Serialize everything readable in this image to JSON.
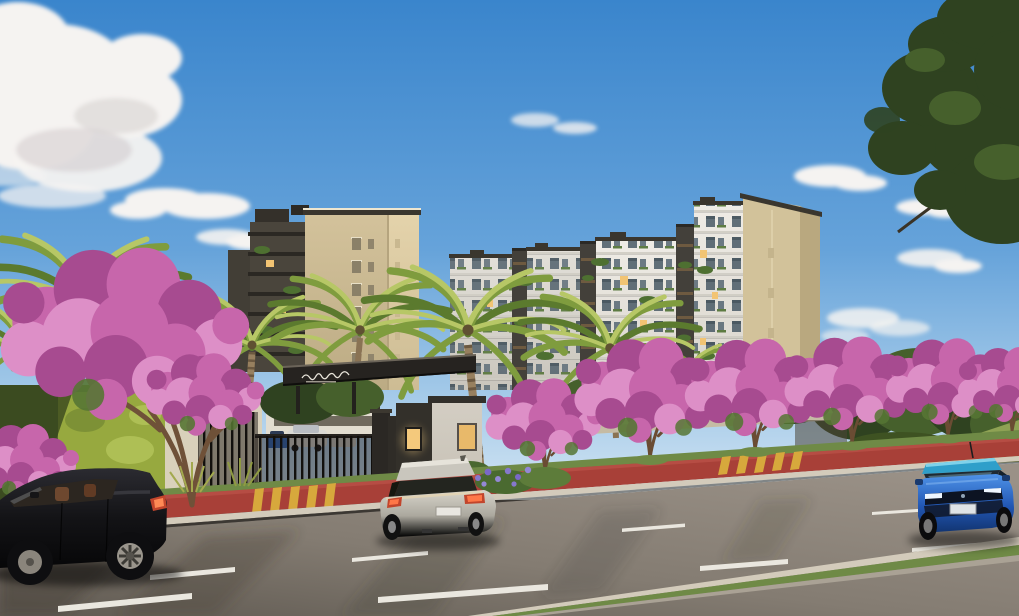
{
  "meta": {
    "type": "architectural-rendering",
    "description": "Street-level rendering of a gated residential condominium: a beige mid-rise tower and a long white apartment block with dark accent strips and a beige end wall, a dark entrance portico with an illegible cursive script logo, palm trees and pink flowering trees, a red cycle lane with yellow driveway stripes, and a wide asphalt road with dashed lane markings, a grass median and three passing hatchback cars under a blue sky with scattered clouds and a dark tree branch overhanging the top-right corner.",
    "time_of_day": "late afternoon sunlight from the right"
  },
  "colors": {
    "sky_top": "#3a85cc",
    "sky_mid": "#66a3da",
    "sky_low": "#a6cbe9",
    "sky_horizon": "#d3e5f3",
    "cloud": "#f5f3f1",
    "cloud_shade": "#c9c2c4",
    "foliage_dark": "#2f4220",
    "foliage_light": "#46602c",
    "facade_beige": "#cdbc94",
    "facade_beige_light": "#decca4",
    "facade_beige_end": "#d2c29a",
    "facade_white": "#e9e6df",
    "facade_white_shade": "#d7d3ca",
    "strip_dark": "#43403a",
    "parapet": "#3a362e",
    "window_dark": "#51616c",
    "window_lit": "#f2c473",
    "plant_green": "#4e7031",
    "canopy_dark": "#262320",
    "gate_dark": "#1d1b18",
    "wall_cream": "#d9d1bb",
    "hedge": "#55682c",
    "hedge_lit": "#97a93f",
    "palm_dark": "#5b7a2e",
    "palm_mid": "#7f9c3e",
    "palm_light": "#b7c766",
    "trunk": "#6a4c33",
    "palm_trunk": "#97805f",
    "pink_main": "#c766ab",
    "pink_dark": "#a74b90",
    "pink_light": "#dd8fc7",
    "bike_lane": "#a84038",
    "stripe_yellow": "#d7a83c",
    "asphalt_light": "#9a9187",
    "asphalt_dark": "#5f5951",
    "lane_mark": "#eae7df",
    "curb": "#d3cbbb",
    "sidewalk": "#c6bda6",
    "grass": "#6f8a46",
    "grass_lit": "#8ea254",
    "car_black": "#17171a",
    "car_silver": "#b7b4aa",
    "car_blue": "#2660c8",
    "car_blue_roof": "#2f9fca",
    "tail_light": "#c2452c",
    "agapanthus": "#8678cc"
  },
  "scene": {
    "sky": {
      "clouds": "scattered cumulus, large puff upper-left, small wisps center and right"
    },
    "buildings": [
      {
        "id": "left-tower",
        "label": "beige mid-rise tower with dark balcony wing",
        "floors_visible": 7
      },
      {
        "id": "right-complex",
        "label": "long white apartment block, dark vertical strips, balconies with plants, beige end wall",
        "floors_visible": 8
      }
    ],
    "entrance": {
      "canopy": "dark horizontal portico",
      "sign": {
        "style": "white cursive script logo",
        "legible": false
      },
      "guard_house": {
        "walls": "white and dark gray",
        "windows_lit": 2
      },
      "gate": "dark vertical-bar sliding gate",
      "vehicles_inside": [
        "blue compact",
        "white suv",
        "white car"
      ]
    },
    "vegetation": {
      "palm_trees": 6,
      "flowering_trees": 7,
      "flower_color": "pink",
      "left_feature": "bright vertical-garden hedge wall",
      "accents": [
        "purple agapanthus clump",
        "ornamental grasses",
        "green trees behind perimeter wall",
        "grass hill far right"
      ]
    },
    "street": {
      "bike_lane": "red, running full width along the curb",
      "crosswalk_stripes": "yellow stripes at two driveways",
      "road": "three+ lanes with staggered white dashes and long tree shadows",
      "median": "concrete-edged grass strip lower right"
    },
    "vehicles": [
      {
        "id": "black-hatchback",
        "position": "foreground left",
        "view": "side, facing left"
      },
      {
        "id": "silver-hatchback",
        "position": "center",
        "view": "rear three-quarter, driving away"
      },
      {
        "id": "blue-hatchback",
        "position": "right",
        "view": "front three-quarter, approaching"
      }
    ]
  }
}
